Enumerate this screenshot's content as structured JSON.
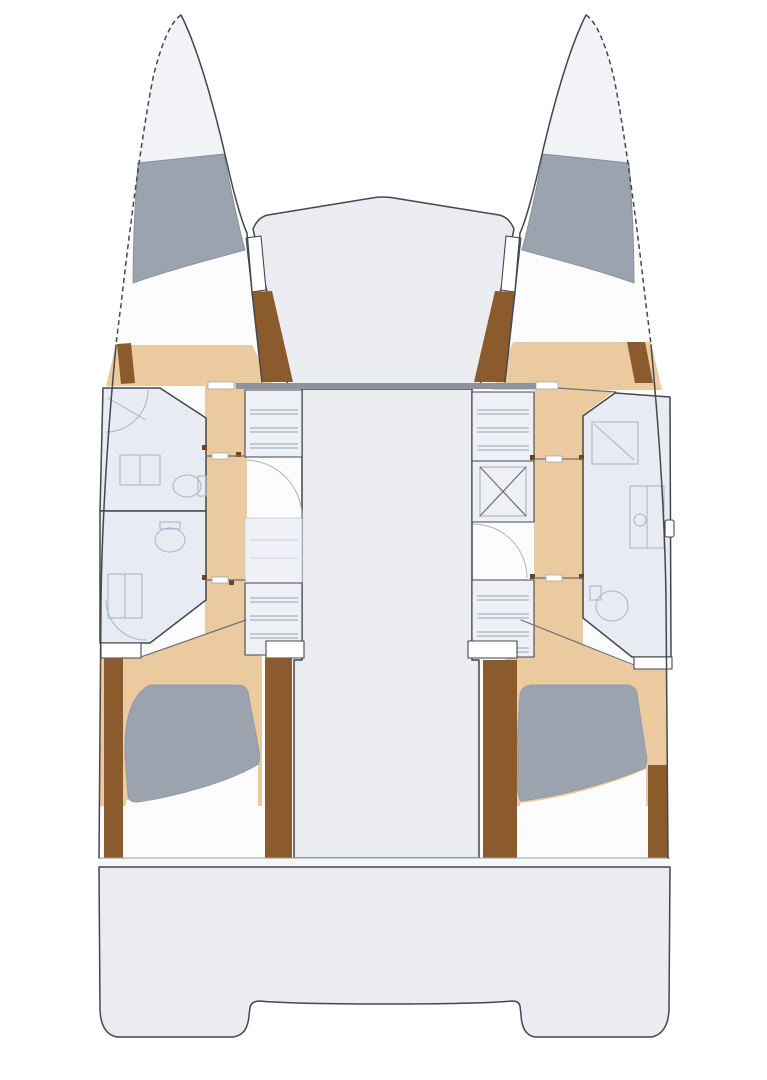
{
  "meta": {
    "label": "Catamaran yacht interior floor plan, top-down view with bow up"
  },
  "colors": {
    "background": "#ffffff",
    "hull_fill": "#fcfcfd",
    "bow_tip_fill": "#f2f3f6",
    "deck_fill": "#eaecf0",
    "band_fill": "#f5f6f8",
    "box_fill": "#eef0f5",
    "berth_gray": "#9ba3af",
    "floor_tan": "#ecca9f",
    "wood_brown": "#8b5a2d",
    "wood_dark": "#6f431f",
    "bath_fill": "#e8ebf2",
    "fixture_fill": "#f3f5f9",
    "fixture_line": "#a9b3c7",
    "shelf_line": "#9aa5b5",
    "outline_dark": "#43474e",
    "wall_gray": "#8d939e",
    "line_mid": "#6a6f78"
  },
  "vessel": {
    "type": "catamaran",
    "orientation": "bow-up",
    "hull_count": 2,
    "port_hull": {
      "spaces": [
        "bow locker",
        "forward berth",
        "forward head",
        "aft head",
        "companionway corridor",
        "aft cabin double berth"
      ]
    },
    "starboard_hull": {
      "spaces": [
        "bow locker",
        "forward berth",
        "head with shower",
        "companionway corridor",
        "aft cabin double berth"
      ]
    },
    "bridgedeck": {
      "spaces": [
        "foredeck",
        "saloon",
        "cockpit",
        "transom steps"
      ]
    }
  }
}
